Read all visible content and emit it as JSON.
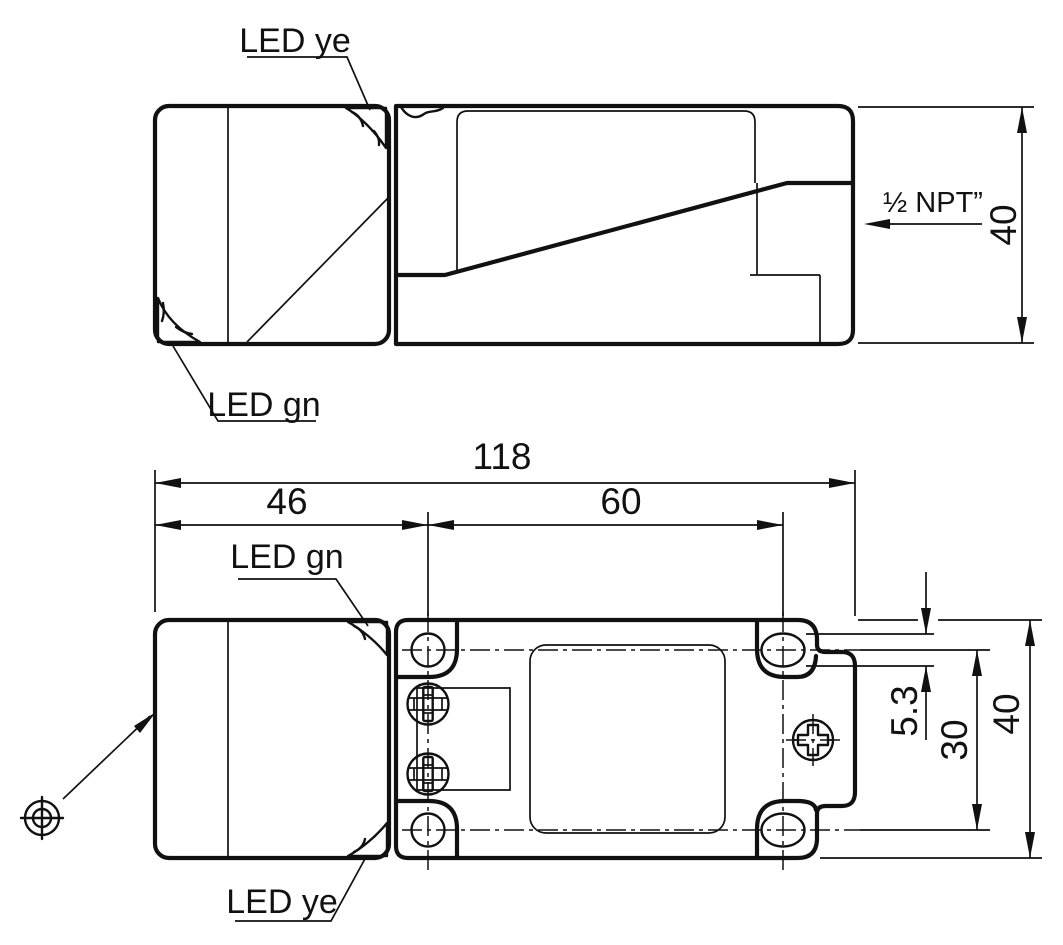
{
  "drawing": {
    "background": "#ffffff",
    "line_color": "#111111",
    "views": {
      "side": {
        "labels": {
          "led_top": "LED ye",
          "led_bottom": "LED gn",
          "conduit": "½ NPT”"
        },
        "dims": {
          "height": "40"
        }
      },
      "plan": {
        "labels": {
          "led_top": "LED gn",
          "led_bottom": "LED ye"
        },
        "dims": {
          "overall_length": "118",
          "head_length": "46",
          "hole_spacing_length": "60",
          "mount_slot_width": "5.3",
          "hole_spacing_height": "30",
          "height": "40"
        }
      }
    }
  }
}
